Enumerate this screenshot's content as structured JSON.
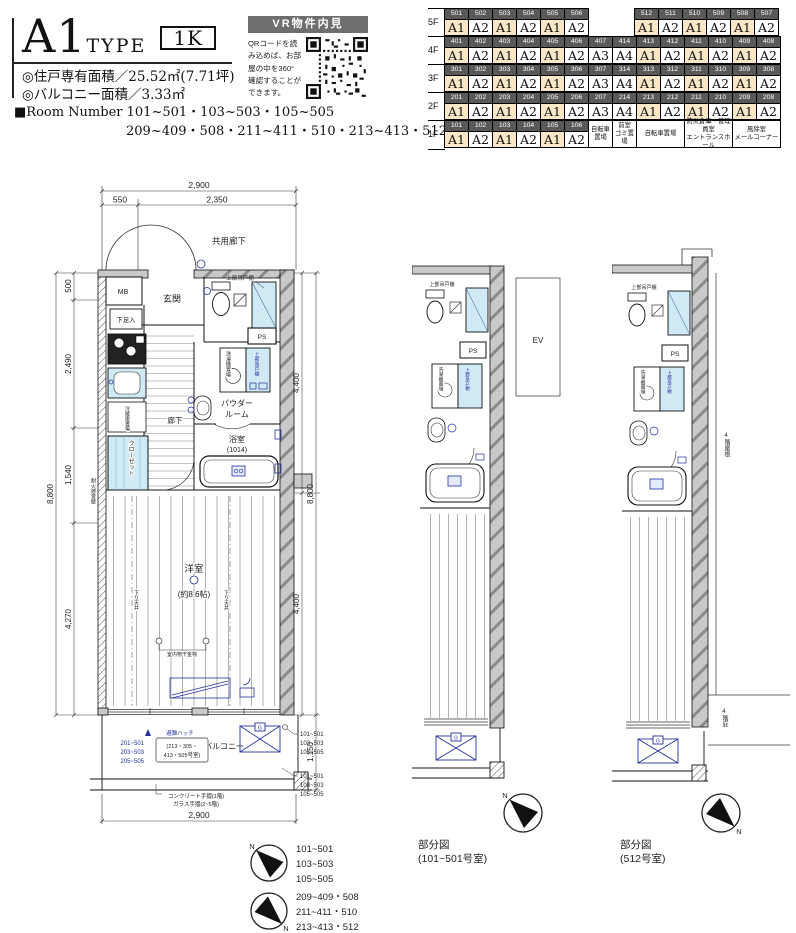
{
  "header": {
    "type_name": "A1",
    "type_word": "TYPE",
    "layout_badge": "1K",
    "area_line1": "◎住戸専有面積／25.52㎡(7.71坪)",
    "area_line2": "◎バルコニー面積／3.33㎡",
    "room_number_prefix": "■Room Number ",
    "room_number_line1": "101~501・103~503・105~505",
    "room_number_line2": "209~409・508・211~411・510・213~413・512"
  },
  "vr": {
    "title": "VR物件内見",
    "desc_lines": [
      "QRコードを読",
      "み込めば、お部",
      "屋の中を360°",
      "確認することが",
      "できます。"
    ]
  },
  "floor_table": {
    "highlight_type": "A1",
    "floors": [
      {
        "label": "5F",
        "cells": [
          {
            "no": "501",
            "type": "A1"
          },
          {
            "no": "502",
            "type": "A2"
          },
          {
            "no": "503",
            "type": "A1"
          },
          {
            "no": "504",
            "type": "A2"
          },
          {
            "no": "505",
            "type": "A1"
          },
          {
            "no": "506",
            "type": "A2"
          },
          {
            "gap": true
          },
          {
            "gap": true
          },
          {
            "no": "512",
            "type": "A1"
          },
          {
            "no": "511",
            "type": "A2"
          },
          {
            "no": "510",
            "type": "A1"
          },
          {
            "no": "509",
            "type": "A2"
          },
          {
            "no": "508",
            "type": "A1"
          },
          {
            "no": "507",
            "type": "A2"
          }
        ]
      },
      {
        "label": "4F",
        "cells": [
          {
            "no": "401",
            "type": "A1"
          },
          {
            "no": "402",
            "type": "A2"
          },
          {
            "no": "403",
            "type": "A1"
          },
          {
            "no": "404",
            "type": "A2"
          },
          {
            "no": "405",
            "type": "A1"
          },
          {
            "no": "406",
            "type": "A2"
          },
          {
            "no": "407",
            "type": "A3"
          },
          {
            "no": "414",
            "type": "A4"
          },
          {
            "no": "413",
            "type": "A1"
          },
          {
            "no": "412",
            "type": "A2"
          },
          {
            "no": "411",
            "type": "A1"
          },
          {
            "no": "410",
            "type": "A2"
          },
          {
            "no": "409",
            "type": "A1"
          },
          {
            "no": "408",
            "type": "A2"
          }
        ]
      },
      {
        "label": "3F",
        "cells": [
          {
            "no": "301",
            "type": "A1"
          },
          {
            "no": "302",
            "type": "A2"
          },
          {
            "no": "303",
            "type": "A1"
          },
          {
            "no": "304",
            "type": "A2"
          },
          {
            "no": "305",
            "type": "A1"
          },
          {
            "no": "306",
            "type": "A2"
          },
          {
            "no": "307",
            "type": "A3"
          },
          {
            "no": "314",
            "type": "A4"
          },
          {
            "no": "313",
            "type": "A1"
          },
          {
            "no": "312",
            "type": "A2"
          },
          {
            "no": "311",
            "type": "A1"
          },
          {
            "no": "310",
            "type": "A2"
          },
          {
            "no": "309",
            "type": "A1"
          },
          {
            "no": "308",
            "type": "A2"
          }
        ]
      },
      {
        "label": "2F",
        "cells": [
          {
            "no": "201",
            "type": "A1"
          },
          {
            "no": "202",
            "type": "A2"
          },
          {
            "no": "203",
            "type": "A1"
          },
          {
            "no": "204",
            "type": "A2"
          },
          {
            "no": "205",
            "type": "A1"
          },
          {
            "no": "206",
            "type": "A2"
          },
          {
            "no": "207",
            "type": "A3"
          },
          {
            "no": "214",
            "type": "A4"
          },
          {
            "no": "213",
            "type": "A1"
          },
          {
            "no": "212",
            "type": "A2"
          },
          {
            "no": "211",
            "type": "A1"
          },
          {
            "no": "210",
            "type": "A2"
          },
          {
            "no": "209",
            "type": "A1"
          },
          {
            "no": "208",
            "type": "A2"
          }
        ]
      },
      {
        "label": "1F",
        "cells": [
          {
            "no": "101",
            "type": "A1"
          },
          {
            "no": "102",
            "type": "A2"
          },
          {
            "no": "103",
            "type": "A1"
          },
          {
            "no": "104",
            "type": "A2"
          },
          {
            "no": "105",
            "type": "A1"
          },
          {
            "no": "106",
            "type": "A2"
          },
          {
            "facility": [
              "自転車",
              "置場"
            ],
            "span": 1
          },
          {
            "facility": [
              "前室",
              "ゴミ置場"
            ],
            "span": 1
          },
          {
            "facility": [
              "自転車置場"
            ],
            "span": 2
          },
          {
            "facility": [
              "防災倉庫・管理員室",
              "エントランスホール"
            ],
            "span": 2
          },
          {
            "facility": [
              "風除室",
              "メールコーナー"
            ],
            "span": 2
          }
        ]
      }
    ]
  },
  "main_plan": {
    "dim_top_total": "2,900",
    "dim_top_a": "550",
    "dim_top_b": "2,350",
    "dim_left": [
      "500",
      "2,490",
      "1,540",
      "4,270"
    ],
    "dim_left_total": "8,800",
    "dim_right_a": "4,400",
    "dim_right_b": "4,400",
    "dim_right_total": "8,800",
    "dim_balcony": "1,150",
    "dim_bottom": "2,900",
    "corridor": "共用廊下",
    "mb": "MB",
    "entrance": "玄関",
    "shoe_box": "下足入",
    "hallway": "廊下",
    "cabinet_top": "上部吊戸棚",
    "ps": "PS",
    "washer": "洗濯機置場",
    "cabinet_blue": "上部吊戸棚",
    "powder1": "パウダー",
    "powder2": "ルーム",
    "fridge": "冷蔵庫置場",
    "closet": "クローゼット",
    "bath": "浴室",
    "bath_size": "(1014)",
    "west_room": "洋室",
    "west_size": "(約8.6帖)",
    "drop_ceiling_l": "下り天井",
    "drop_ceiling_r": "下り天井",
    "fire_wall": "耐火遮音壁",
    "laundry": "室内物干金物",
    "balcony": "バルコニー",
    "hatch_mark": "避難ハッチ",
    "hatch_rooms1": "(213・305・",
    "hatch_rooms2": "413・505号室)",
    "g_label": "G",
    "rooms_blue": [
      "201~501",
      "203~503",
      "205~505"
    ],
    "rooms_right_top": [
      "101~501",
      "103~503",
      "105~505"
    ],
    "rooms_right_bottom": [
      "101~501",
      "103~503",
      "105~505"
    ],
    "handrail1": "コンクリート手摺(1階)",
    "handrail2": "ガラス手摺(2~5階)"
  },
  "partial1": {
    "caption1": "部分図",
    "caption2": "(101~501号室)",
    "ev": "EV",
    "ps": "PS",
    "cabinet_top": "上部吊戸棚",
    "washer": "洗濯機置場",
    "cabinet_blue": "上部吊戸棚",
    "g": "G"
  },
  "partial2": {
    "caption1": "部分図",
    "caption2": "(512号室)",
    "ps": "PS",
    "cabinet_top": "上部吊戸棚",
    "washer": "洗濯機置場",
    "cabinet_blue": "上部吊戸棚",
    "roof": "4階屋根",
    "eave": "4階庇",
    "g": "G"
  },
  "compass": {
    "n": "N"
  },
  "legend1": [
    "101~501",
    "103~503",
    "105~505"
  ],
  "legend2": [
    "209~409・508",
    "211~411・510",
    "213~413・512"
  ]
}
